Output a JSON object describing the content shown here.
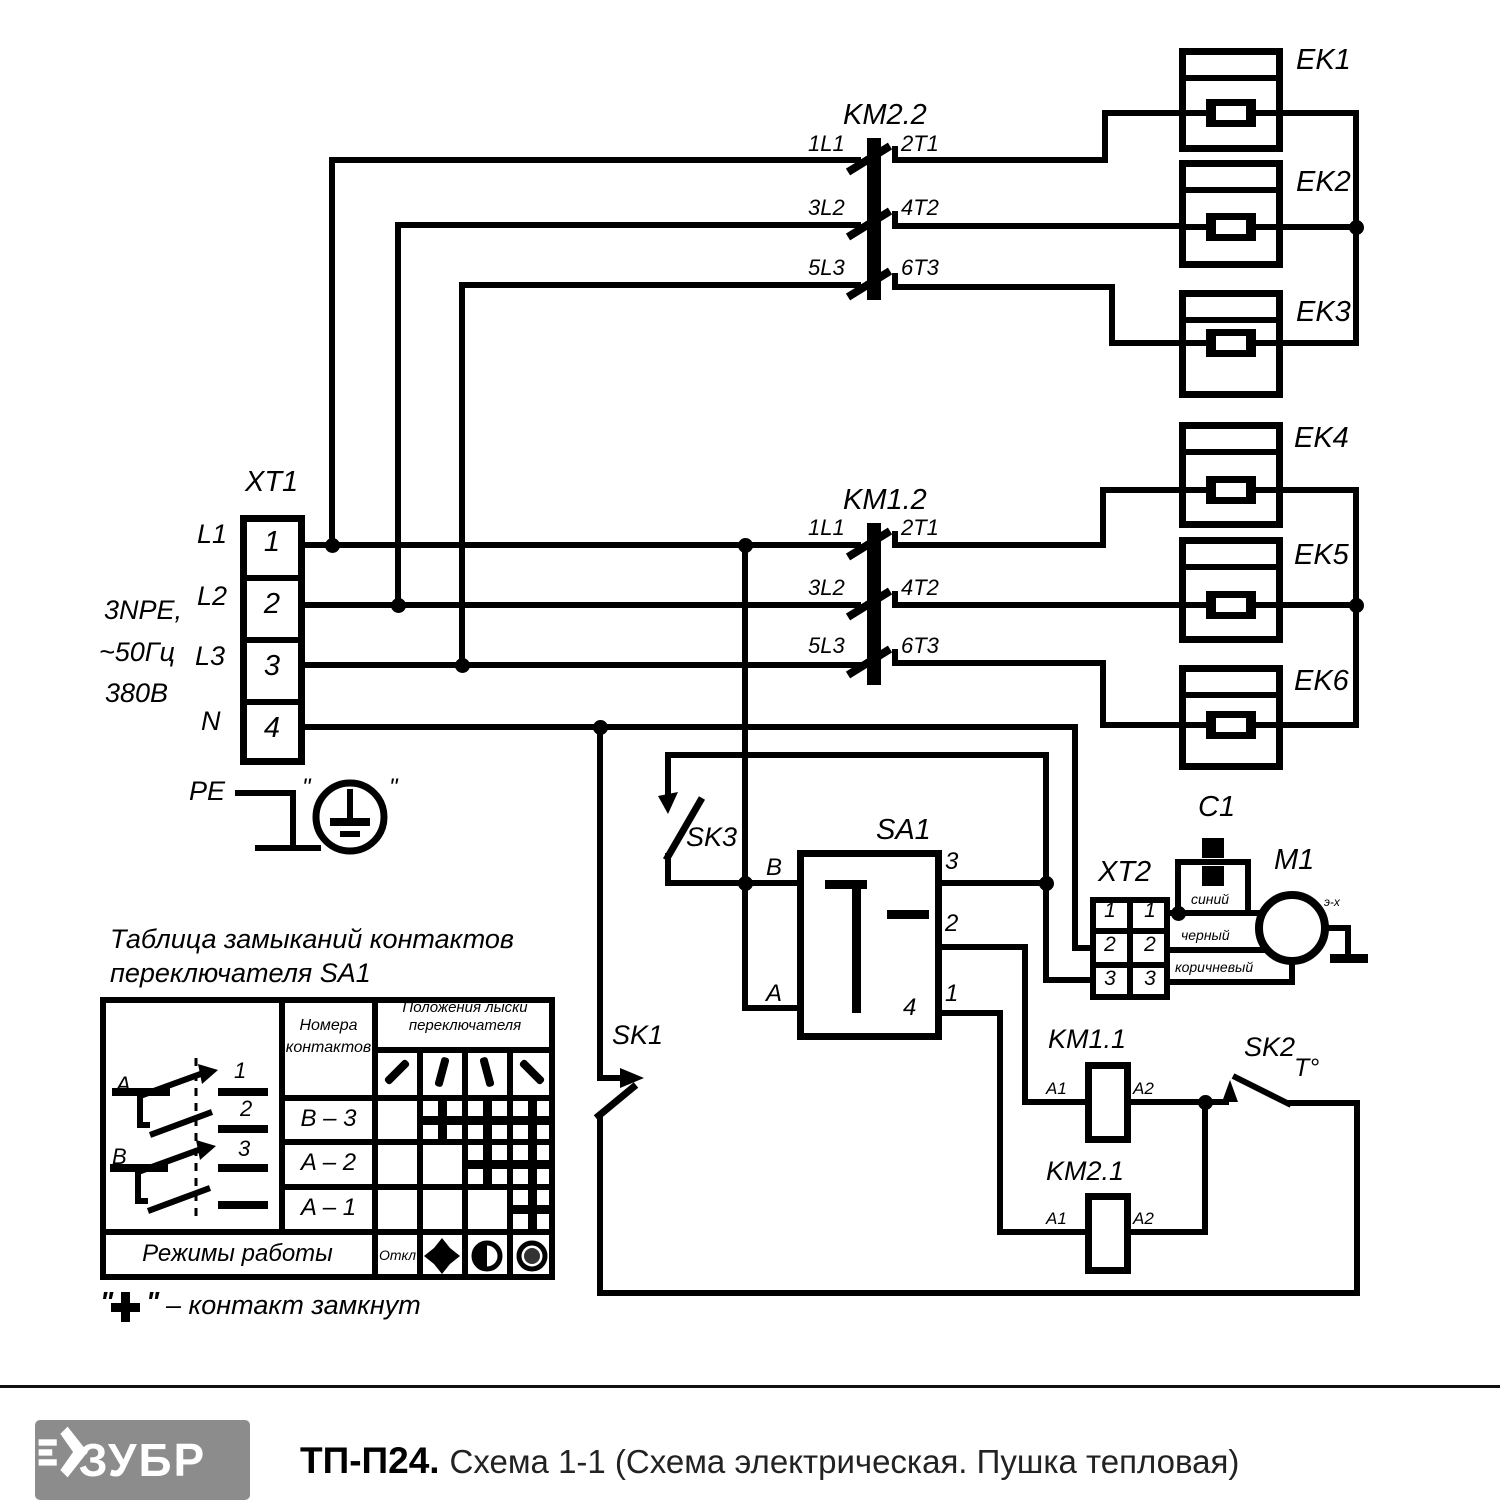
{
  "footer": {
    "brand": "ЗУБР",
    "model": "ТП-П24.",
    "subtitle": "Схема 1-1 (Схема электрическая. Пушка тепловая)"
  },
  "colors": {
    "line": "#000000",
    "logo_bg": "#8c8c8c",
    "paper": "#ffffff"
  },
  "table": {
    "title_line1": "Таблица замыканий контактов",
    "title_line2": "переключателя SA1",
    "col_header_contacts_1": "Номера",
    "col_header_contacts_2": "контактов",
    "col_header_positions_1": "Положения лыски",
    "col_header_positions_2": "переключателя",
    "modes_label": "Режимы работы",
    "off_label": "Откл",
    "rows": [
      {
        "label": "B – 3",
        "closed": [
          false,
          true,
          true,
          true
        ]
      },
      {
        "label": "A – 2",
        "closed": [
          false,
          false,
          true,
          true
        ]
      },
      {
        "label": "A – 1",
        "closed": [
          false,
          false,
          false,
          true
        ]
      }
    ],
    "mode_icons": [
      "off-text",
      "fan-icon",
      "half-heat-icon",
      "full-heat-icon"
    ],
    "footnote_quote_open": "\"",
    "footnote_plus": "+",
    "footnote_quote_close": "\"",
    "footnote_text": "– контакт замкнут"
  },
  "labels": [
    {
      "name": "ek1-label",
      "text": "EK1",
      "x": 1296,
      "y": 46,
      "s": 29
    },
    {
      "name": "ek2-label",
      "text": "EK2",
      "x": 1296,
      "y": 168,
      "s": 29
    },
    {
      "name": "ek3-label",
      "text": "EK3",
      "x": 1296,
      "y": 298,
      "s": 29
    },
    {
      "name": "ek4-label",
      "text": "EK4",
      "x": 1294,
      "y": 424,
      "s": 29
    },
    {
      "name": "ek5-label",
      "text": "EK5",
      "x": 1294,
      "y": 541,
      "s": 29
    },
    {
      "name": "ek6-label",
      "text": "EK6",
      "x": 1294,
      "y": 667,
      "s": 29
    },
    {
      "name": "km22-label",
      "text": "KM2.2",
      "x": 843,
      "y": 101,
      "s": 29
    },
    {
      "name": "km22-term-1l1",
      "text": "1L1",
      "x": 808,
      "y": 133,
      "s": 22
    },
    {
      "name": "km22-term-2t1",
      "text": "2T1",
      "x": 901,
      "y": 133,
      "s": 22
    },
    {
      "name": "km22-term-3l2",
      "text": "3L2",
      "x": 808,
      "y": 197,
      "s": 22
    },
    {
      "name": "km22-term-4t2",
      "text": "4T2",
      "x": 901,
      "y": 197,
      "s": 22
    },
    {
      "name": "km22-term-5l3",
      "text": "5L3",
      "x": 808,
      "y": 257,
      "s": 22
    },
    {
      "name": "km22-term-6t3",
      "text": "6T3",
      "x": 901,
      "y": 257,
      "s": 22
    },
    {
      "name": "km12-label",
      "text": "KM1.2",
      "x": 843,
      "y": 486,
      "s": 29
    },
    {
      "name": "km12-term-1l1",
      "text": "1L1",
      "x": 808,
      "y": 517,
      "s": 22
    },
    {
      "name": "km12-term-2t1",
      "text": "2T1",
      "x": 901,
      "y": 517,
      "s": 22
    },
    {
      "name": "km12-term-3l2",
      "text": "3L2",
      "x": 808,
      "y": 577,
      "s": 22
    },
    {
      "name": "km12-term-4t2",
      "text": "4T2",
      "x": 901,
      "y": 577,
      "s": 22
    },
    {
      "name": "km12-term-5l3",
      "text": "5L3",
      "x": 808,
      "y": 635,
      "s": 22
    },
    {
      "name": "km12-term-6t3",
      "text": "6T3",
      "x": 901,
      "y": 635,
      "s": 22
    },
    {
      "name": "xt1-label",
      "text": "XT1",
      "x": 245,
      "y": 468,
      "s": 29
    },
    {
      "name": "phase-l1-label",
      "text": "L1",
      "x": 197,
      "y": 521,
      "s": 27
    },
    {
      "name": "phase-l2-label",
      "text": "L2",
      "x": 197,
      "y": 583,
      "s": 27
    },
    {
      "name": "phase-l3-label",
      "text": "L3",
      "x": 195,
      "y": 643,
      "s": 27
    },
    {
      "name": "neutral-label",
      "text": "N",
      "x": 201,
      "y": 708,
      "s": 27
    },
    {
      "name": "supply-spec-1",
      "text": "3NPE,",
      "x": 104,
      "y": 597,
      "s": 27
    },
    {
      "name": "supply-spec-2",
      "text": "~50Гц",
      "x": 99,
      "y": 639,
      "s": 27
    },
    {
      "name": "supply-spec-3",
      "text": "380В",
      "x": 105,
      "y": 680,
      "s": 27
    },
    {
      "name": "pe-label",
      "text": "PE",
      "x": 189,
      "y": 778,
      "s": 27
    },
    {
      "name": "earth-quote-left",
      "text": "\"",
      "x": 302,
      "y": 776,
      "s": 24
    },
    {
      "name": "earth-quote-right",
      "text": "\"",
      "x": 389,
      "y": 776,
      "s": 24
    },
    {
      "name": "xt1-terminal-1",
      "text": "1",
      "x": 252,
      "y": 528,
      "s": 29,
      "w": 40
    },
    {
      "name": "xt1-terminal-2",
      "text": "2",
      "x": 252,
      "y": 590,
      "s": 29,
      "w": 40
    },
    {
      "name": "xt1-terminal-3",
      "text": "3",
      "x": 252,
      "y": 652,
      "s": 29,
      "w": 40
    },
    {
      "name": "xt1-terminal-4",
      "text": "4",
      "x": 252,
      "y": 714,
      "s": 29,
      "w": 40
    },
    {
      "name": "sk3-label",
      "text": "SK3",
      "x": 686,
      "y": 824,
      "s": 27
    },
    {
      "name": "sa1-label",
      "text": "SA1",
      "x": 876,
      "y": 816,
      "s": 29
    },
    {
      "name": "sa1-term-b",
      "text": "B",
      "x": 766,
      "y": 856,
      "s": 24
    },
    {
      "name": "sa1-term-a",
      "text": "A",
      "x": 766,
      "y": 982,
      "s": 24
    },
    {
      "name": "sa1-term-3",
      "text": "3",
      "x": 945,
      "y": 850,
      "s": 24
    },
    {
      "name": "sa1-term-2",
      "text": "2",
      "x": 945,
      "y": 912,
      "s": 24
    },
    {
      "name": "sa1-term-1",
      "text": "1",
      "x": 945,
      "y": 982,
      "s": 24
    },
    {
      "name": "sa1-term-4",
      "text": "4",
      "x": 903,
      "y": 996,
      "s": 24
    },
    {
      "name": "sk1-label",
      "text": "SK1",
      "x": 612,
      "y": 1022,
      "s": 27
    },
    {
      "name": "xt2-label",
      "text": "XT2",
      "x": 1098,
      "y": 858,
      "s": 29
    },
    {
      "name": "xt2-cell-1l",
      "text": "1",
      "x": 1096,
      "y": 900,
      "s": 21,
      "w": 28
    },
    {
      "name": "xt2-cell-1r",
      "text": "1",
      "x": 1136,
      "y": 900,
      "s": 21,
      "w": 28
    },
    {
      "name": "xt2-cell-2l",
      "text": "2",
      "x": 1096,
      "y": 934,
      "s": 21,
      "w": 28
    },
    {
      "name": "xt2-cell-2r",
      "text": "2",
      "x": 1136,
      "y": 934,
      "s": 21,
      "w": 28
    },
    {
      "name": "xt2-cell-3l",
      "text": "3",
      "x": 1096,
      "y": 968,
      "s": 21,
      "w": 28
    },
    {
      "name": "xt2-cell-3r",
      "text": "3",
      "x": 1136,
      "y": 968,
      "s": 21,
      "w": 28
    },
    {
      "name": "c1-label",
      "text": "C1",
      "x": 1198,
      "y": 793,
      "s": 29
    },
    {
      "name": "m1-label",
      "text": "M1",
      "x": 1274,
      "y": 846,
      "s": 29
    },
    {
      "name": "wire-color-blue",
      "text": "синий",
      "x": 1191,
      "y": 892,
      "s": 14
    },
    {
      "name": "wire-color-black",
      "text": "черный",
      "x": 1181,
      "y": 928,
      "s": 14
    },
    {
      "name": "wire-color-brown",
      "text": "коричневый",
      "x": 1175,
      "y": 960,
      "s": 14
    },
    {
      "name": "motor-ground-label",
      "text": "э-х",
      "x": 1324,
      "y": 896,
      "s": 12
    },
    {
      "name": "km11-label",
      "text": "KM1.1",
      "x": 1048,
      "y": 1026,
      "s": 27
    },
    {
      "name": "km11-term-a1",
      "text": "A1",
      "x": 1046,
      "y": 1080,
      "s": 17
    },
    {
      "name": "km11-term-a2",
      "text": "A2",
      "x": 1133,
      "y": 1080,
      "s": 17
    },
    {
      "name": "sk2-label",
      "text": "SK2",
      "x": 1244,
      "y": 1034,
      "s": 27
    },
    {
      "name": "sk2-temp-label",
      "text": "T°",
      "x": 1294,
      "y": 1056,
      "s": 25
    },
    {
      "name": "km21-label",
      "text": "KM2.1",
      "x": 1046,
      "y": 1158,
      "s": 27
    },
    {
      "name": "km21-term-a1",
      "text": "A1",
      "x": 1046,
      "y": 1210,
      "s": 17
    },
    {
      "name": "km21-term-a2",
      "text": "A2",
      "x": 1133,
      "y": 1210,
      "s": 17
    },
    {
      "name": "table-title-1",
      "text": "Таблица замыканий контактов",
      "x": 110,
      "y": 926,
      "s": 27
    },
    {
      "name": "table-title-2",
      "text": "переключателя SA1",
      "x": 110,
      "y": 960,
      "s": 27
    },
    {
      "name": "table-header-contacts-1",
      "text": "Номера",
      "x": 282,
      "y": 1018,
      "s": 16,
      "w": 93
    },
    {
      "name": "table-header-contacts-2",
      "text": "контактов",
      "x": 282,
      "y": 1040,
      "s": 16,
      "w": 93
    },
    {
      "name": "table-header-positions-1",
      "text": "Положения лыски",
      "x": 375,
      "y": 1000,
      "s": 15,
      "w": 180
    },
    {
      "name": "table-header-positions-2",
      "text": "переключателя",
      "x": 375,
      "y": 1018,
      "s": 15,
      "w": 180
    },
    {
      "name": "table-modes-label",
      "text": "Режимы работы",
      "x": 100,
      "y": 1242,
      "s": 24,
      "w": 275
    },
    {
      "name": "table-off-label",
      "text": "Откл",
      "x": 375,
      "y": 1248,
      "s": 14,
      "w": 45
    },
    {
      "name": "pictogram-pole-a",
      "text": "A",
      "x": 116,
      "y": 1074,
      "s": 22
    },
    {
      "name": "pictogram-contact-1",
      "text": "1",
      "x": 234,
      "y": 1060,
      "s": 22
    },
    {
      "name": "pictogram-contact-2",
      "text": "2",
      "x": 240,
      "y": 1098,
      "s": 22
    },
    {
      "name": "pictogram-pole-b",
      "text": "B",
      "x": 112,
      "y": 1146,
      "s": 22
    },
    {
      "name": "pictogram-contact-3",
      "text": "3",
      "x": 238,
      "y": 1138,
      "s": 22
    }
  ]
}
